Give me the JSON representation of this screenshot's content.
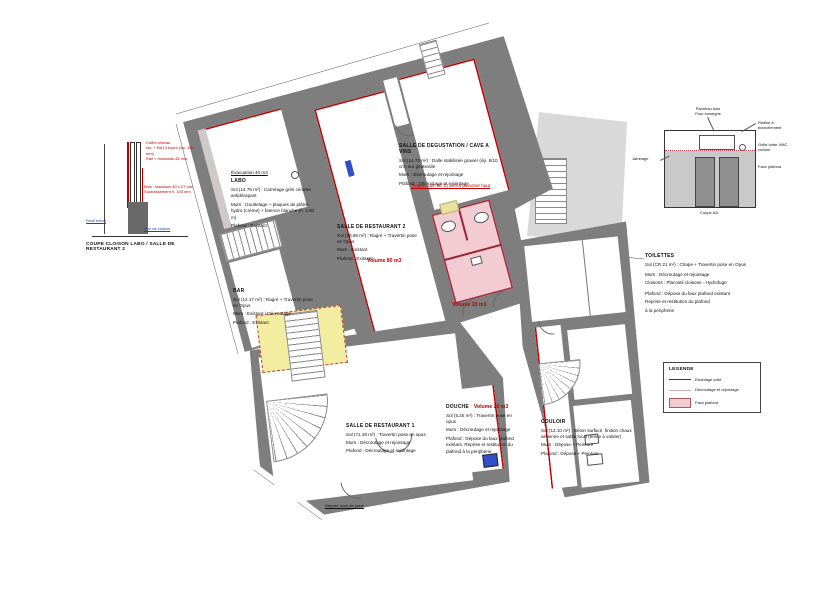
{
  "captions": {
    "coupe_cloison": "COUPE CLOISON LABO / SALLE DE RESTAURANT 2",
    "coupe_aa": "Coupe AA",
    "reprise_seuil": "Reprise seuil de porte"
  },
  "rooms": {
    "labo": {
      "name": "LABO",
      "note": "Évacuation 40 m3",
      "sol": "Sol (14.76 m²) : Carrelage grès cérame antidérapant",
      "murs": "Murs : Gouttelage + plaques de plâtre hydro (crème) + faïence blanche (h. 1.80 m)",
      "plafond": "Plafond : Existant"
    },
    "restaurant2": {
      "name": "SALLE DE RESTAURANT 2",
      "sol": "Sol (29.98 m²) : Ragré + Travertin pose en Opus",
      "murs": "Murs : Existant",
      "plafond": "Plafond : Existant",
      "volume": "Volume 80 m3"
    },
    "degustation": {
      "name": "SALLE DE DEGUSTATION / CAVE A VINS",
      "sol": "Sol (14.73 m²) : Dalle stabilisée gravier (ép. 8/10 cm) sur géotextile",
      "murs": "Murs : Décroutage et rejointage",
      "plafond": "Plafond : Décroutage et rejointage",
      "note": "Trappe (dim 80 S) accès plancher haut"
    },
    "bar": {
      "name": "BAR",
      "sol": "Sol (12.17 m²) : Ragré + Travertin pose en Opus",
      "murs": "Murs : Existant / Décroutage",
      "plafond": "Plafond : Existant"
    },
    "restaurant1": {
      "name": "SALLE DE RESTAURANT 1",
      "sol": "Sol (71.26 m²) : Travertin pose en opus",
      "murs": "Murs : Décroutage et rejointage",
      "plafond": "Plafond : Décroutage et rejointage"
    },
    "douche": {
      "name": "DOUCHE",
      "volume": "Volume 26 m3",
      "sol": "Sol (5.25 m²) : Travertin pose en opus",
      "murs": "Murs : Décroutage et rejointage",
      "plafond": "Plafond : Dépose du faux plafond existant. Reprise et restitution du plafond à la périphérie"
    },
    "couloir": {
      "name": "COULOIR",
      "sol": "Sol (12.10 m²) : Béton surfacé, finition chaux aérienne et sable local (teinte à valider)",
      "murs": "Murs : Dépose + Peinture",
      "plafond": "Plafond : Dépose + Peinture"
    },
    "toilettes": {
      "name": "TOILETTES",
      "volume": "Volume 20 m3",
      "sol": "Sol (CR.21 m²) : Chape + Travertin pose en Opus",
      "murs": "Murs : Décroutage et rejointage",
      "cloisons": "Cloisons : Placostil cloisons - Hydrofuge",
      "plafond1": "Plafond : Dépose du faux plafond existant",
      "plafond2": "Reprise et restitution du plafond",
      "plafond3": "à la périphérie"
    }
  },
  "details": {
    "coupe_cloison": {
      "red1a": "Coffre réseau",
      "red1b": "Iso. + BA13 hydro (ép. 100 mm)",
      "red1c": "Rail + montants 48 mm",
      "red2a": "Bois : tasseaux 40 x 27 mm",
      "red2b": "Soubassement h. 100 mm",
      "blue1": "Seuil béton",
      "blue2": "Nez de cloison"
    },
    "coupe_aa": {
      "a1a": "Panneau bois",
      "a1b": "Pour enseigne",
      "a2": "Platine à branchement",
      "a3": "Grille hotte VMC cuisine",
      "a4": "Faux plafond",
      "a5": "Jambage"
    }
  },
  "legend": {
    "title": "LEGENDE",
    "items": [
      {
        "label": "Doublage collé"
      },
      {
        "label": "Décroutage et rejointage"
      },
      {
        "label": "Faux plafond"
      }
    ]
  }
}
